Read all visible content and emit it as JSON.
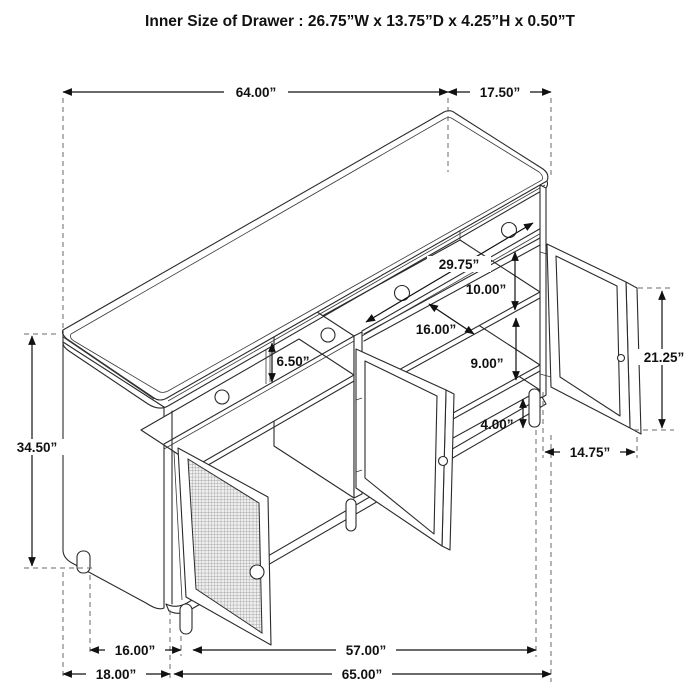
{
  "title": "Inner Size of Drawer  : 26.75”W x 13.75”D x 4.25”H x 0.50”T",
  "drawing": {
    "subject": "sideboard-cabinet-isometric-dimension-diagram",
    "features": [
      "top",
      "three-drawer-row",
      "left-mesh-door-open",
      "middle-framed-door-open",
      "right-framed-door-open",
      "interior-shelves",
      "round-legs"
    ]
  },
  "dimensions": {
    "overall_width": "64.00”",
    "overall_depth": "17.50”",
    "overall_height": "34.50”",
    "right_compartment_width": "29.75”",
    "upper_shelf_spacing": "10.00”",
    "shelf_depth": "16.00”",
    "lower_shelf_spacing": "9.00”",
    "drawer_front_height": "6.50”",
    "leg_height": "4.00”",
    "door_height": "21.25”",
    "door_width": "14.75”",
    "left_section_width": "16.00”",
    "right_section_width": "57.00”",
    "side_base_depth": "18.00”",
    "front_base_width": "65.00”"
  }
}
